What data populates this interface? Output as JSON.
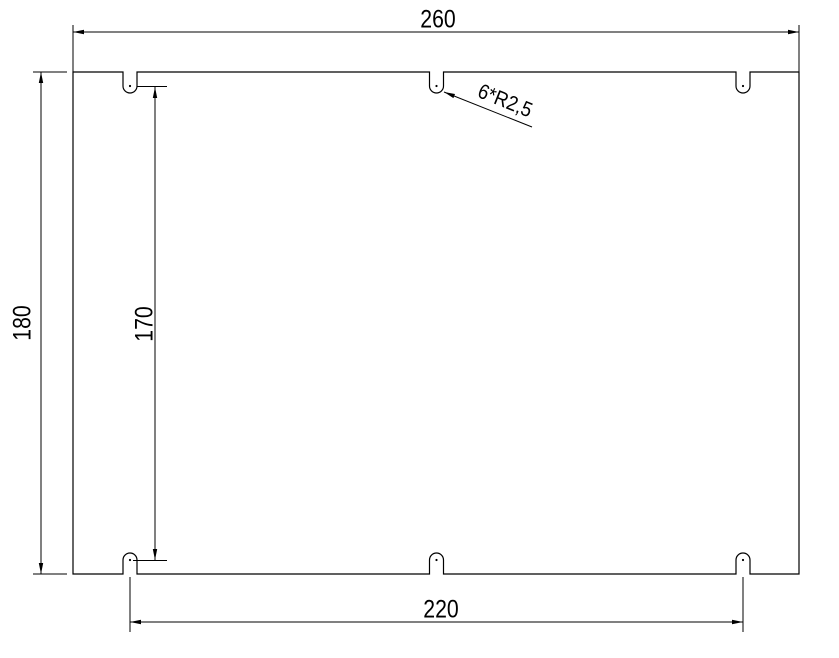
{
  "drawing": {
    "type": "technical-part-drawing",
    "part": "rectangular plate with six semicircular notches (3 top edge, 3 bottom edge)",
    "line_color": "#000000",
    "background_color": "#ffffff",
    "dimensions": {
      "overall_width": "260",
      "overall_height": "180",
      "notch_center_height": "170",
      "notch_spacing_width": "220",
      "notch_radius_note": "6*R2,5"
    }
  }
}
